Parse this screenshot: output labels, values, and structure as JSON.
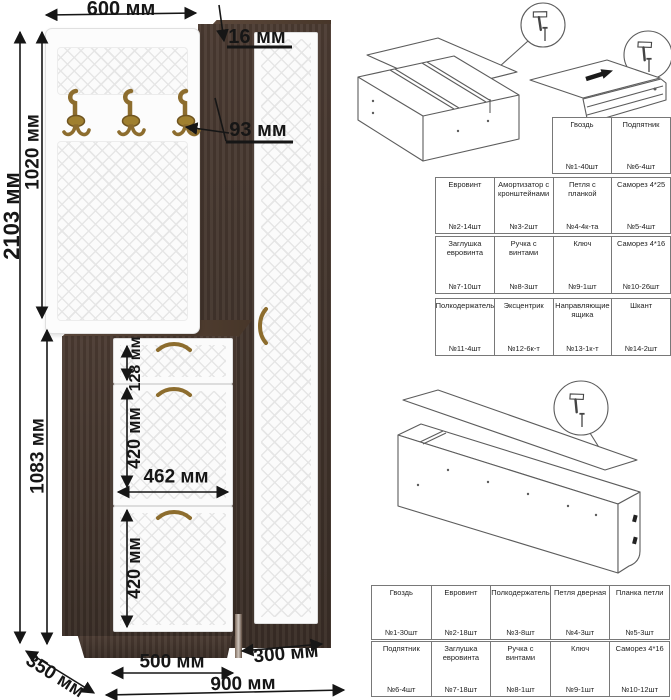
{
  "dims": {
    "top_width": "600 мм",
    "panel_thickness": "16 мм",
    "hook_offset": "93 мм",
    "total_height": "2103 мм",
    "upper_height": "1020 мм",
    "lower_height": "1083 мм",
    "drawer_front": "128 мм",
    "flap_upper": "420 мм",
    "inner_width": "462 мм",
    "flap_lower": "420 мм",
    "depth": "350 мм",
    "cabinet_width": "500 мм",
    "wardrobe_width": "300 мм",
    "total_width": "900 мм"
  },
  "parts_table_upper": {
    "rows": [
      [
        {
          "name": "Гвоздь",
          "qty": "№1-40шт",
          "icon": "nail-icon"
        },
        {
          "name": "Подпятник",
          "qty": "№6-4шт",
          "icon": "footpad-icon"
        }
      ],
      [
        {
          "name": "Евровинт",
          "qty": "№2-14шт",
          "icon": "euroscrew-icon"
        },
        {
          "name": "Амортизатор с кронштейнами",
          "qty": "№3-2шт",
          "icon": "gaslift-icon"
        },
        {
          "name": "Петля с планкой",
          "qty": "№4-4к-та",
          "icon": "hinge-icon"
        },
        {
          "name": "Саморез 4*25",
          "qty": "№5-4шт",
          "icon": "screw-icon"
        }
      ],
      [
        {
          "name": "Заглушка евровинта",
          "qty": "№7-10шт",
          "icon": "plug-icon"
        },
        {
          "name": "Ручка с винтами",
          "qty": "№8-3шт",
          "icon": "handle-icon"
        },
        {
          "name": "Ключ",
          "qty": "№9-1шт",
          "icon": "key-icon"
        },
        {
          "name": "Саморез 4*16",
          "qty": "№10-26шт",
          "icon": "screw-icon"
        }
      ],
      [
        {
          "name": "Полкодержатель",
          "qty": "№11-4шт",
          "icon": "shelfpin-icon"
        },
        {
          "name": "Эксцентрик",
          "qty": "№12-6к-т",
          "icon": "cam-icon"
        },
        {
          "name": "Направляющие ящика",
          "qty": "№13-1к-т",
          "icon": "slides-icon"
        },
        {
          "name": "Шкант",
          "qty": "№14-2шт",
          "icon": "dowel-icon"
        }
      ]
    ]
  },
  "parts_table_lower": {
    "rows": [
      [
        {
          "name": "Гвоздь",
          "qty": "№1-30шт",
          "icon": "nail-icon"
        },
        {
          "name": "Евровинт",
          "qty": "№2-18шт",
          "icon": "euroscrew-icon"
        },
        {
          "name": "Полкодержатель",
          "qty": "№3-8шт",
          "icon": "shelfpin-icon"
        },
        {
          "name": "Петля дверная",
          "qty": "№4-3шт",
          "icon": "hinge-icon"
        },
        {
          "name": "Планка петли",
          "qty": "№5-3шт",
          "icon": "hingeplate-icon"
        }
      ],
      [
        {
          "name": "Подпятник",
          "qty": "№6-4шт",
          "icon": "footpad-icon"
        },
        {
          "name": "Заглушка евровинта",
          "qty": "№7-18шт",
          "icon": "plug-icon"
        },
        {
          "name": "Ручка с винтами",
          "qty": "№8-1шт",
          "icon": "handle-icon"
        },
        {
          "name": "Ключ",
          "qty": "№9-1шт",
          "icon": "key-icon"
        },
        {
          "name": "Саморез 4*16",
          "qty": "№10-12шт",
          "icon": "screw-icon"
        }
      ]
    ]
  },
  "colors": {
    "wenge": "#43342c",
    "wenge_light": "#5f4b3e",
    "front_white": "#fbfbfb",
    "bronze": "#8d6d2e",
    "dimension_line": "#161616",
    "sketch_line": "#5c5c5c",
    "table_border": "#787878"
  }
}
